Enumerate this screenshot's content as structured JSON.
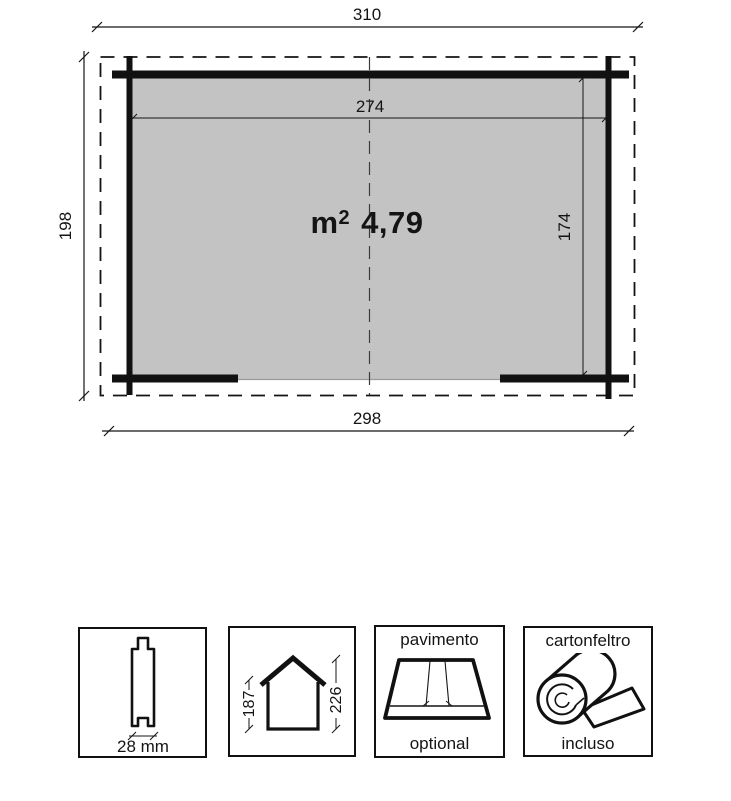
{
  "plan": {
    "dim_roof_width": "310",
    "dim_inner_width": "274",
    "dim_depth": "198",
    "dim_inner_depth": "174",
    "dim_wall_width": "298",
    "area": {
      "unit": "m",
      "sup": "2",
      "value": "4,79"
    }
  },
  "features": {
    "plank": {
      "label": "28 mm"
    },
    "profile": {
      "wall_height": "187",
      "ridge_height": "226"
    },
    "floor": {
      "title": "pavimento",
      "note": "optional"
    },
    "felt": {
      "title": "cartonfeltro",
      "note": "incluso"
    }
  },
  "colors": {
    "interior_fill": "#c3c3c3",
    "line_color": "#141414",
    "background": "#ffffff"
  }
}
